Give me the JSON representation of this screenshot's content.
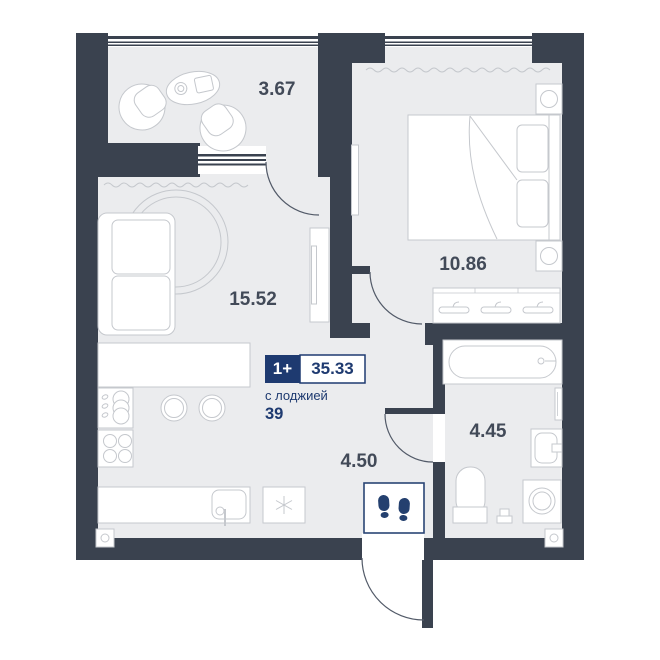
{
  "plan": {
    "type": "apartment-floor-plan",
    "badge": {
      "rooms": "1+",
      "area": "35.33",
      "note": "с лоджией",
      "note_area": "39"
    },
    "rooms": {
      "loggia": "3.67",
      "living": "15.52",
      "bedroom": "10.86",
      "bathroom": "4.45",
      "hall": "4.50"
    },
    "colors": {
      "wall": "#3a424f",
      "floor": "#ebecee",
      "furniture_stroke": "#c5c8cd",
      "door_stroke": "#525a68",
      "accent_navy": "#1e3a70",
      "footprints_navy": "#24406f",
      "label_text": "#424a58"
    },
    "icons": {
      "fridge": "snowflake-icon",
      "entry_mat": "footprints-icon",
      "wardrobe": "hanger-icon"
    }
  }
}
